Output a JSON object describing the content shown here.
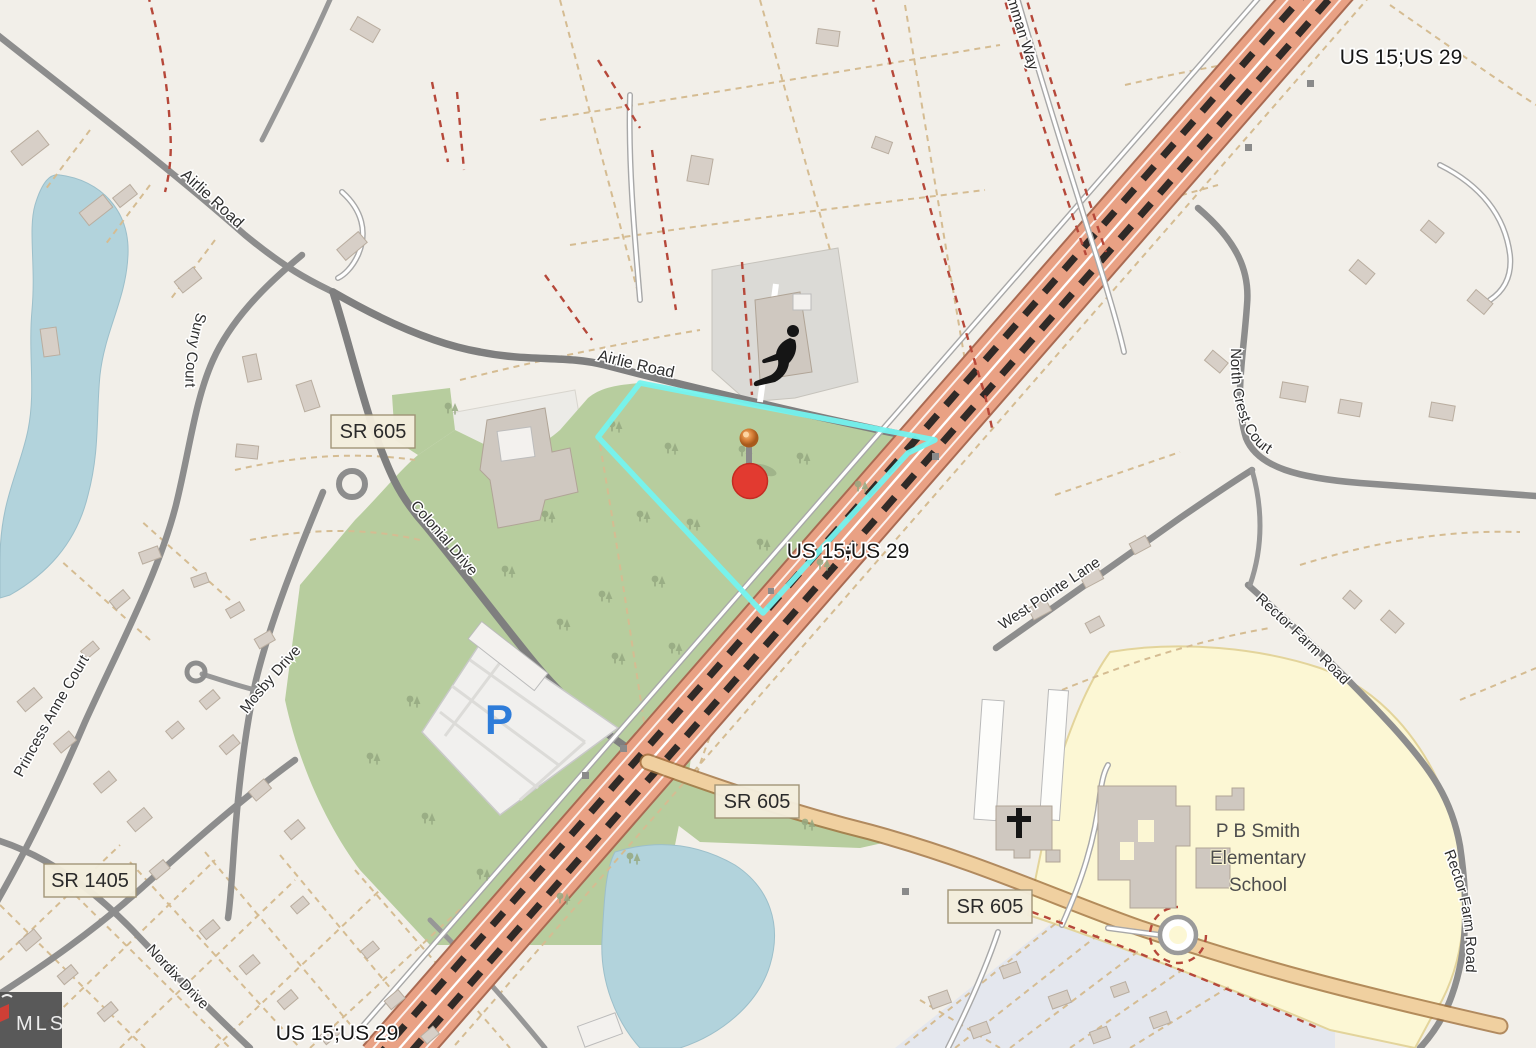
{
  "attribution": {
    "mls_label": "MLS"
  },
  "road_labels": {
    "us_route_top": "US 15;US 29",
    "us_route_mid": "US 15;US 29",
    "us_route_bottom": "US 15;US 29",
    "airlie_road_nw": "Airlie Road",
    "airlie_road_mid": "Airlie Road",
    "hamman_way": "anamman Way",
    "surry_court": "Surry Court",
    "princess_anne_court": "Princess Anne Court",
    "mosby_drive": "Mosby Drive",
    "colonial_drive": "Colonial Drive",
    "nordix_drive": "Nordix Drive",
    "north_crest_court": "North Crest Court",
    "west_pointe_lane": "West Pointe Lane",
    "rector_farm_road_upper": "Rector Farm Road",
    "rector_farm_road_lower": "Rector Farm Road"
  },
  "route_shields": {
    "sr605_west": "SR 605",
    "sr605_mid": "SR 605",
    "sr605_east": "SR 605",
    "sr1405": "SR 1405"
  },
  "pois": {
    "school_name_line1": "P B Smith",
    "school_name_line2": "Elementary",
    "school_name_line3": "School",
    "parking_symbol": "P"
  },
  "colors": {
    "land": "#f2efe9",
    "forest": "#b7cd9e",
    "water": "#b2d3dc",
    "school-grounds": "#fcf7d4",
    "highway": "#e9a184",
    "secondary-road": "#f0d0a0",
    "parcel-line": "#d5bc92",
    "boundary-red": "#b6483a",
    "highlight-cyan": "#74f3ef",
    "pin-red": "#e23a30",
    "parking-blue": "#2e7cd9"
  }
}
